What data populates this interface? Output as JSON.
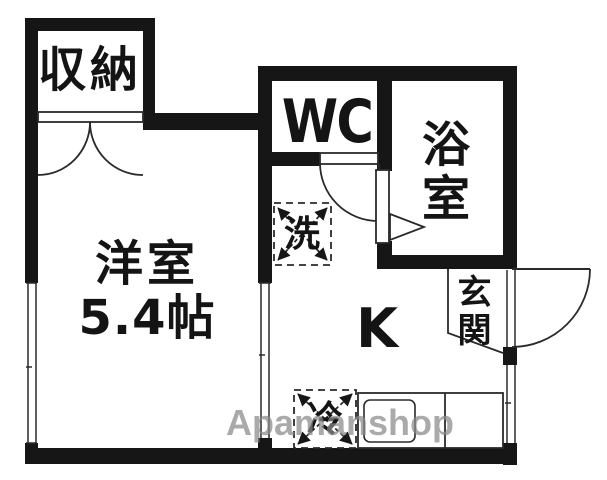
{
  "floorplan": {
    "watermark": "Apamanshop",
    "colors": {
      "wall": "#161616",
      "line": "#2a2a2a",
      "watermark": "#8a8a8a",
      "background": "#ffffff"
    },
    "rooms": {
      "closet": {
        "label": "収納"
      },
      "western_room": {
        "label": "洋室",
        "size": "5.4帖"
      },
      "wc": {
        "label": "WC"
      },
      "bath": {
        "label": "浴室"
      },
      "kitchen": {
        "label": "K"
      },
      "entrance": {
        "label": "玄関"
      },
      "washer": {
        "label": "洗"
      },
      "refrigerator": {
        "label": "冷"
      }
    }
  }
}
